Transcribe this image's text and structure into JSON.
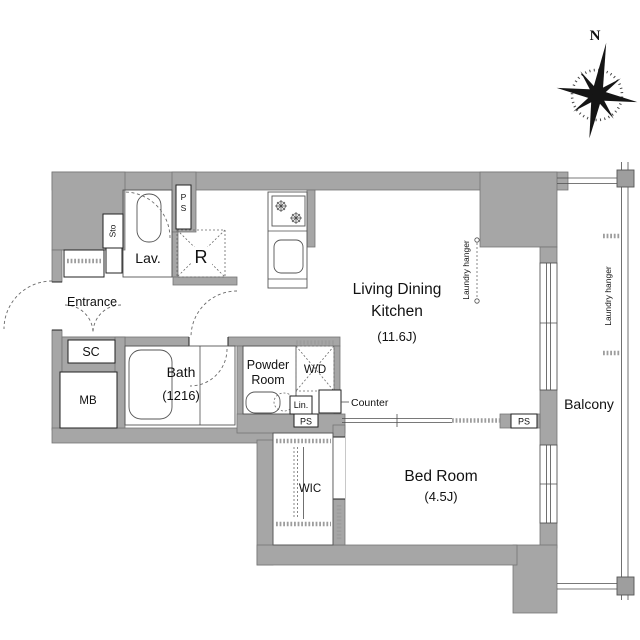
{
  "plan": {
    "compass": {
      "north": "N"
    },
    "rooms": {
      "ldk_line1": "Living Dining",
      "ldk_line2": "Kitchen",
      "ldk_size": "(11.6J)",
      "bedroom": "Bed Room",
      "bedroom_size": "(4.5J)",
      "bath": "Bath",
      "bath_size": "(1216)",
      "powder_line1": "Powder",
      "powder_line2": "Room",
      "entrance": "Entrance",
      "balcony": "Balcony",
      "wic": "WIC",
      "lavatory": "Lav."
    },
    "fixtures": {
      "washer_dryer": "W/D",
      "linen": "Lin.",
      "counter": "Counter",
      "refrigerator": "R",
      "shoe_closet": "SC",
      "meter_box": "MB",
      "storage": "Sto"
    },
    "utility": {
      "pipe_space": "PS"
    },
    "annotations": {
      "laundry_hanger": "Laundry hanger"
    },
    "colors": {
      "wall": "#a6a6a6",
      "line": "#4d4d4d"
    }
  }
}
